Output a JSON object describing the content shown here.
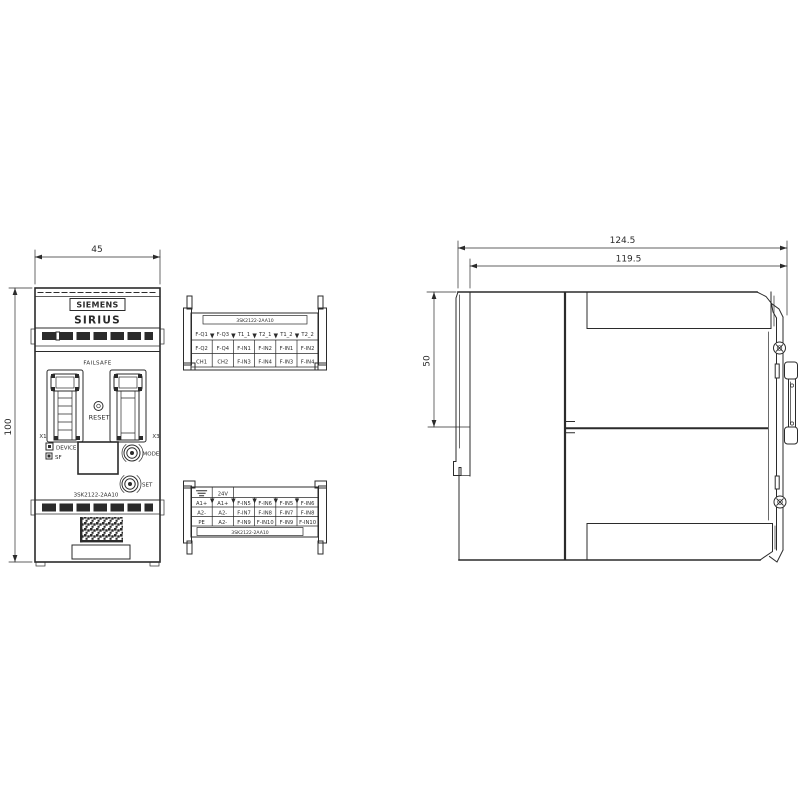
{
  "front": {
    "brand": "SIEMENS",
    "series": "SIRIUS",
    "failsafe": "FAILSAFE",
    "reset": "RESET",
    "x1": "X1",
    "x3": "X3",
    "device_led": "DEVICE",
    "sf_led": "SF",
    "mode": "MODE",
    "set": "SET",
    "part_number": "3SK2122-2AA10"
  },
  "dims": {
    "width": "45",
    "height": "100",
    "depth_total": "124.5",
    "depth_body": "119.5",
    "upper_section": "50"
  },
  "terminal_top": {
    "header": "3SK2122-2AA10",
    "row1": [
      "F-Q1",
      "F-Q3",
      "T1_1",
      "T2_1",
      "T1_2",
      "T2_2"
    ],
    "row2": [
      "F-Q2",
      "F-Q4",
      "F-IN1",
      "F-IN2",
      "F-IN1",
      "F-IN2"
    ],
    "row3": [
      "CH1",
      "CH2",
      "F-IN3",
      "F-IN4",
      "F-IN3",
      "F-IN4"
    ]
  },
  "terminal_bottom": {
    "supply": "24V",
    "row1": [
      "A1+",
      "A1+",
      "F-IN5",
      "F-IN6",
      "F-IN5",
      "F-IN6"
    ],
    "row2": [
      "A2-",
      "A2-",
      "F-IN7",
      "F-IN8",
      "F-IN7",
      "F-IN8"
    ],
    "row3": [
      "PE",
      "A2-",
      "F-IN9",
      "F-IN10",
      "F-IN9",
      "F-IN10"
    ],
    "footer": "3SK2122-2AA10"
  },
  "colors": {
    "ink": "#2b2b2b",
    "background": "#ffffff"
  }
}
